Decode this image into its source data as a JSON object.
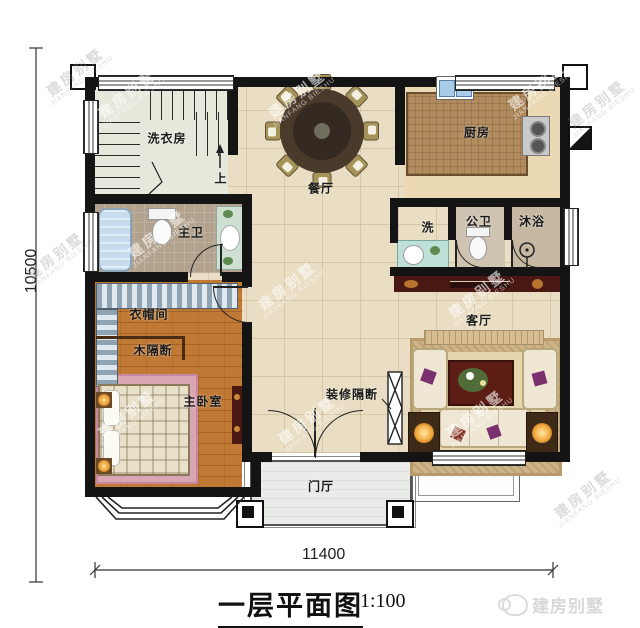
{
  "watermark": {
    "cn": "建房别墅",
    "en": "JIANFANG BIESHU"
  },
  "labels": {
    "laundry": "洗衣房",
    "up": "上",
    "dining": "餐厅",
    "kitchen": "厨房",
    "master_bath": "主卫",
    "wash": "洗",
    "public_bath": "公卫",
    "shower": "沐浴",
    "living": "客厅",
    "cloakroom": "衣帽间",
    "wood_partition": "木隔断",
    "master_bedroom": "主卧室",
    "deco_partition": "装修隔断",
    "foyer": "门厅"
  },
  "dimensions": {
    "bottom": "11400",
    "left": "10500"
  },
  "title": {
    "name": "一层平面图",
    "scale": "1:100"
  },
  "brand": {
    "logo_text": "建房别墅"
  },
  "colors": {
    "wall": "#141414",
    "floor_hall": "#e9dec3",
    "floor_wood": "#c07a36",
    "floor_stairs": "#e4e9dc",
    "floor_kitchen": "#ead9b2",
    "floor_bath": "#b2a28d",
    "tv_cabinet": "#4a1813",
    "bathtub": "#c4dcee",
    "porch": "#e9ece8",
    "bed_rug": "#dba6b4"
  }
}
